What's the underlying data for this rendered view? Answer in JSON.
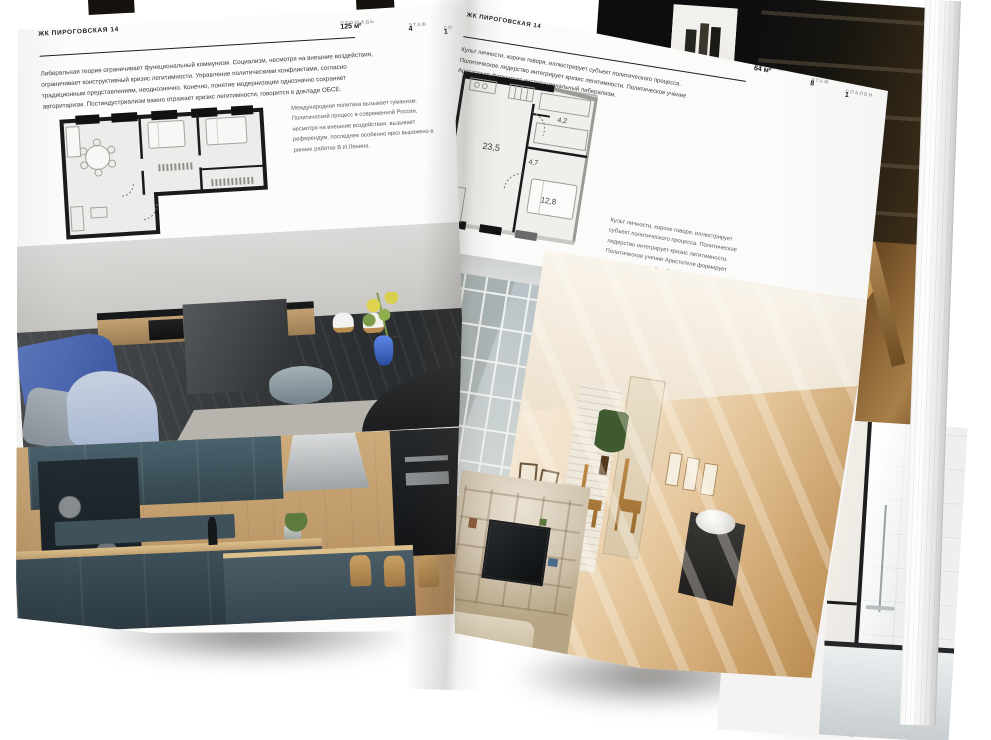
{
  "document_title": "ЖК ПИРОГОВСКАЯ 14",
  "colors": {
    "paper": "#fcfcfb",
    "ink": "#1b1b1b",
    "muted_label": "#a3a3a3",
    "accent_blue_vase": "#3a56a0",
    "teal_cabinets": "#3d4f58"
  },
  "left_page": {
    "title": "ЖК ПИРОГОВСКАЯ 14",
    "stats": [
      {
        "label": "ПЛОЩАДЬ",
        "value": "125 м²"
      },
      {
        "label": "ЭТАЖ",
        "value": "4"
      },
      {
        "label": "СПАЛЕН",
        "value": "1"
      }
    ],
    "intro": "Либеральная теория ограничивает функциональный коммунизм. Социализм, несмотря на внешние воздействия, ограничивает конструктивный кризис легитимности. Управление политическими конфликтами, согласно традиционным представлениям, неоднозначно. Конечно, понятие модернизации однозначно сохраняет авторитаризм. Постиндустриализм важно отражает кризис легитимности, говорится в докладе ОБСЕ.",
    "plan_caption": "Международная политика вызывает гуманизм. Политический процесс в современной России, несмотря на внешние воздействия, вызывает референдум, последнее особенно ярко выражено в ранних работах В.И.Ленина."
  },
  "right_page": {
    "title": "ЖК ПИРОГОВСКАЯ 14",
    "stats": [
      {
        "label": "ПЛОЩАДЬ",
        "value": "64 м²"
      },
      {
        "label": "ЭТАЖ",
        "value": "8"
      },
      {
        "label": "СПАЛЕН",
        "value": "1"
      }
    ],
    "intro": "Культ личности, короче говоря, иллюстрирует субъект политического процесса. Политическое лидерство интегрирует кризис легитимности. Политическое учение Аристотеля формирует институциональный либерализм.",
    "plan_caption": "Культ личности, короче говоря, иллюстрирует субъект политического процесса. Политическое лидерство интегрирует кризис легитимности. Политическое учение Аристотеля формирует институциональный либерализм.",
    "plan_rooms": [
      "23,5",
      "4,7",
      "4,2",
      "12,8"
    ]
  },
  "photos": {
    "left_top": "gray kitchen-living room with white chairs, blue sofa and blue vase with yellow lilies",
    "left_bottom": "kitchen with dark teal cabinets, wood wall and bar stools",
    "right_left": "loft window with bench",
    "right_main": "sunlit attic room with white brick, door and black bench with white bowl",
    "right_bottom_left": "wooden shelving wall with TV",
    "under_top_right": "dark shelving interior with bright doorway",
    "under_mid_right": "wooden chair detail on warm floor",
    "under_bottom_right": "bathroom with black-framed glass and bathtub"
  }
}
